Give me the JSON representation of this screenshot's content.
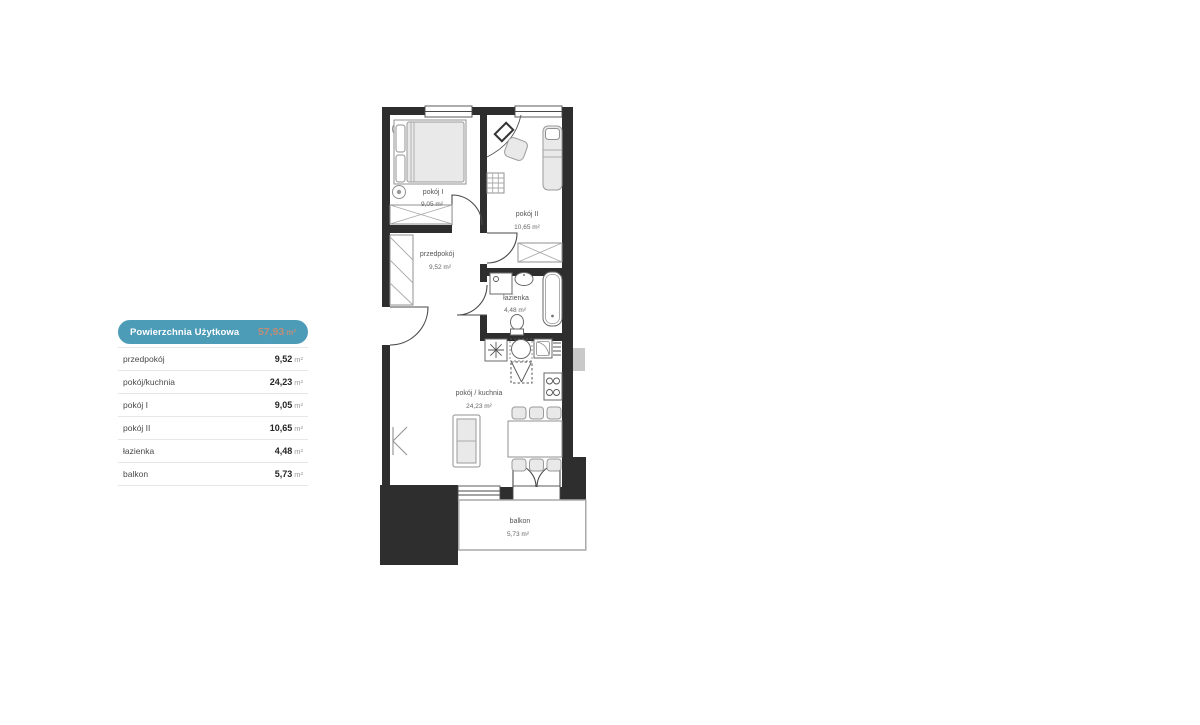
{
  "colors": {
    "accent_teal": "#4c9cb8",
    "total_value_text": "#bf8d76",
    "wall": "#2e2e2e",
    "separator": "#e7e7e7"
  },
  "panel": {
    "total": {
      "label": "Powierzchnia Użytkowa",
      "value": "57,93",
      "unit": "m²"
    },
    "rows": [
      {
        "label": "przedpokój",
        "value": "9,52",
        "unit": "m²"
      },
      {
        "label": "pokój/kuchnia",
        "value": "24,23",
        "unit": "m²"
      },
      {
        "label": "pokój I",
        "value": "9,05",
        "unit": "m²"
      },
      {
        "label": "pokój II",
        "value": "10,65",
        "unit": "m²"
      },
      {
        "label": "łazienka",
        "value": "4,48",
        "unit": "m²"
      },
      {
        "label": "balkon",
        "value": "5,73",
        "unit": "m²"
      }
    ]
  },
  "floorplan": {
    "rooms": [
      {
        "name": "pokój I",
        "area": "9,05 m²"
      },
      {
        "name": "pokój II",
        "area": "10,65 m²"
      },
      {
        "name": "przedpokój",
        "area": "9,52 m²"
      },
      {
        "name": "łazienka",
        "area": "4,48 m²"
      },
      {
        "name": "pokój / kuchnia",
        "area": "24,23 m²"
      },
      {
        "name": "balkon",
        "area": "5,73 m²"
      }
    ]
  }
}
